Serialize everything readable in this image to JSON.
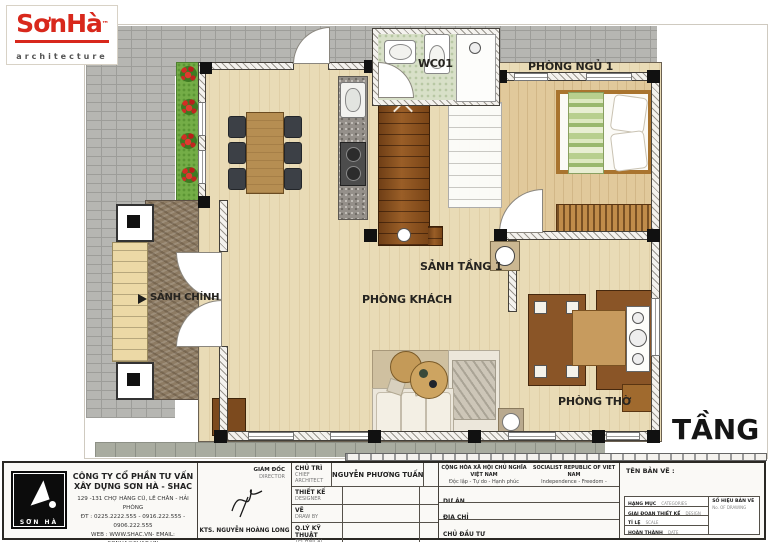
{
  "logo": {
    "brand": "SơnHà",
    "tm": "™",
    "sub": "architecture"
  },
  "floor_plan": {
    "labels": {
      "wc": "WC01",
      "bedroom": "PHÒNG NGỦ 1",
      "floor_hall": "SẢNH TẦNG 1",
      "living": "PHÒNG KHÁCH",
      "main_hall": "SẢNH CHÍNH",
      "worship": "PHÒNG THỜ"
    },
    "floor_title": "TẦNG 1"
  },
  "title_block": {
    "logo_text": "SƠN HÀ",
    "company_line1": "CÔNG TY CỔ PHẦN TƯ VẤN",
    "company_line2": "XÂY DỰNG SƠN HÀ - SHAC",
    "address": "129 -131 CHỢ HÀNG CŨ, LÊ CHÂN - HẢI PHÒNG",
    "phone": "ĐT : 0225.2222.555 - 0916.222.555 - 0906.222.555",
    "web": "WEB : WWW.SHAC.VN- EMAIL: SONHA@SHAC.VN",
    "director_label": "GIÁM ĐỐC",
    "director_sub": "DIRECTOR",
    "director_name": "KTS. NGUYỄN HOÀNG LONG",
    "roles": [
      {
        "label": "CHỦ TRÌ",
        "sub": "CHIEF ARCHITECT",
        "value": "NGUYỄN PHƯƠNG TUẤN"
      },
      {
        "label": "THIẾT KẾ",
        "sub": "DESIGNER",
        "value": ""
      },
      {
        "label": "VẼ",
        "sub": "DRAW BY",
        "value": ""
      },
      {
        "label": "Q.LÝ KỸ THUẬT",
        "sub": "TECHNICAL MANAGER",
        "value": ""
      }
    ],
    "republic": {
      "vn1": "CỘNG HÒA XÃ HỘI CHỦ NGHĨA VIỆT NAM",
      "vn2": "Độc lập - Tự do - Hạnh phúc",
      "en1": "SOCIALIST REPUBLIC OF VIET NAM",
      "en2": "Independence - Freedom - Happiness"
    },
    "info_rows": [
      {
        "label": "DỰ ÁN",
        "sub": "PROJECT"
      },
      {
        "label": "ĐỊA CHỈ",
        "sub": "LOCATION"
      },
      {
        "label": "CHỦ ĐẦU TƯ",
        "sub": "INVESTOR"
      }
    ],
    "drawing": {
      "name_label": "TÊN BẢN VẼ :",
      "rows": [
        {
          "label": "HẠNG MỤC",
          "sub": "CATEGORIES"
        },
        {
          "label": "GIAI ĐOẠN THIẾT KẾ",
          "sub": "DESIGN PHASE"
        },
        {
          "label": "TỈ LỆ",
          "sub": "SCALE"
        },
        {
          "label": "HOÀN THÀNH",
          "sub": "DATE"
        }
      ],
      "number_label": "SỐ HIỆU BẢN VẼ",
      "number_sub": "No. OF DRAWING"
    }
  },
  "colors": {
    "brand_red": "#d42b1e",
    "wood": "#8a5527",
    "floor": "#e9dbb6",
    "grass": "#74ad47"
  }
}
